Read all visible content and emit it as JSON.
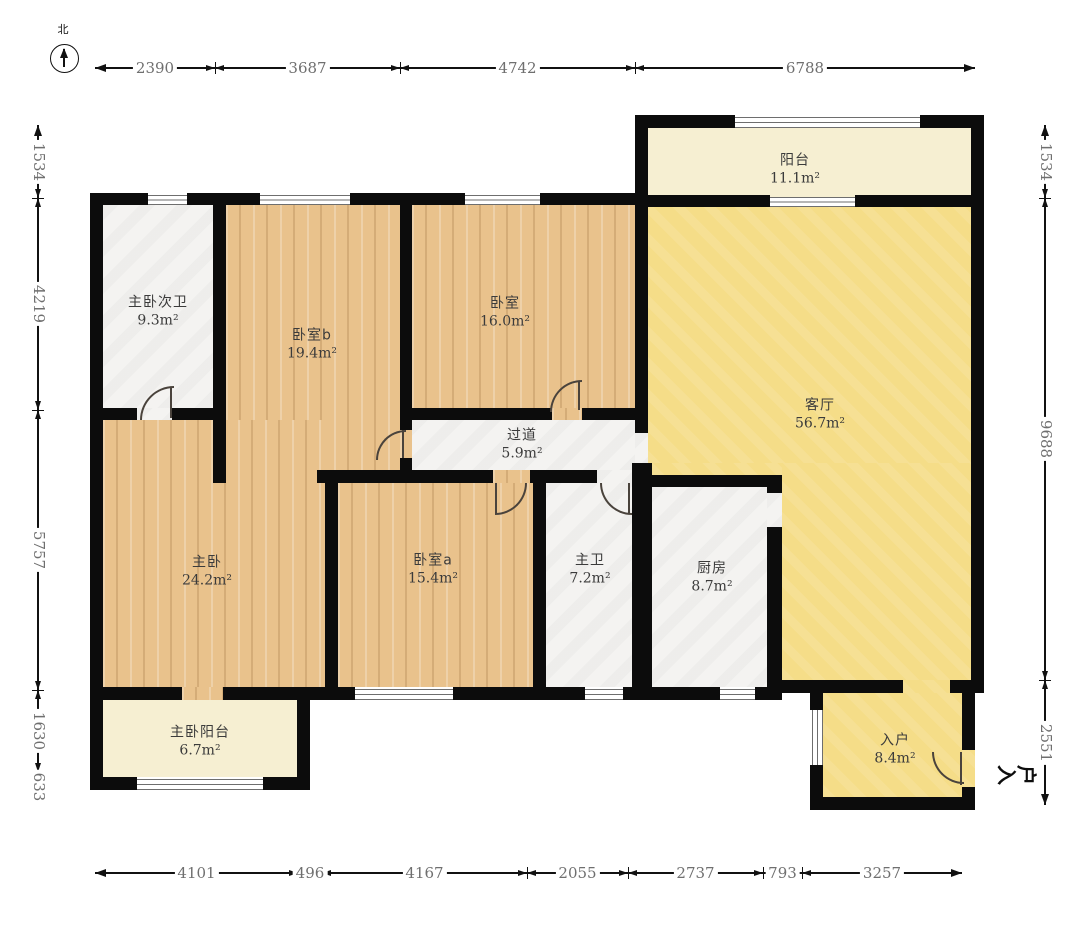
{
  "compass": {
    "label": "北"
  },
  "entry_label": "入户",
  "colors": {
    "wall": "#0c0c0c",
    "wood_floor": "#e9c28c",
    "living_floor": "#f5dd88",
    "balcony_floor": "#f6efd2",
    "tile_floor": "#f4f3f1",
    "dimension_text": "#6f6f6f",
    "label_text": "#3b3b3b"
  },
  "rooms": [
    {
      "id": "zhuwo-ciwei",
      "name": "主卧次卫",
      "area": "9.3m²",
      "floor": "tile",
      "label": [
        158,
        312
      ],
      "rects": [
        [
          103,
          205,
          110,
          203
        ],
        [
          137,
          408,
          35,
          12
        ]
      ]
    },
    {
      "id": "woshi-b",
      "name": "卧室b",
      "area": "19.4m²",
      "floor": "wood",
      "label": [
        312,
        345
      ],
      "rects": [
        [
          226,
          205,
          174,
          265
        ],
        [
          400,
          430,
          12,
          28
        ],
        [
          226,
          470,
          91,
          13
        ]
      ]
    },
    {
      "id": "woshi",
      "name": "卧室",
      "area": "16.0m²",
      "floor": "wood",
      "label": [
        505,
        313
      ],
      "rects": [
        [
          412,
          205,
          223,
          203
        ],
        [
          552,
          408,
          30,
          12
        ]
      ]
    },
    {
      "id": "yangtai",
      "name": "阳台",
      "area": "11.1m²",
      "floor": "cream",
      "label": [
        795,
        170
      ],
      "rects": [
        [
          648,
          128,
          325,
          67
        ],
        [
          770,
          195,
          85,
          12
        ]
      ]
    },
    {
      "id": "keting",
      "name": "客厅",
      "area": "56.7m²",
      "floor": "yellow",
      "label": [
        820,
        415
      ],
      "rects": [
        [
          648,
          207,
          325,
          256
        ],
        [
          782,
          463,
          191,
          217
        ],
        [
          652,
          463,
          130,
          12
        ],
        [
          903,
          680,
          47,
          13
        ]
      ]
    },
    {
      "id": "guodao",
      "name": "过道",
      "area": "5.9m²",
      "floor": "tile",
      "label": [
        522,
        445
      ],
      "rects": [
        [
          412,
          420,
          223,
          50
        ],
        [
          635,
          433,
          13,
          30
        ]
      ]
    },
    {
      "id": "zhuwo",
      "name": "主卧",
      "area": "24.2m²",
      "floor": "wood",
      "label": [
        207,
        572
      ],
      "rects": [
        [
          103,
          420,
          222,
          267
        ],
        [
          182,
          687,
          41,
          13
        ]
      ]
    },
    {
      "id": "woshi-a",
      "name": "卧室a",
      "area": "15.4m²",
      "floor": "wood",
      "label": [
        433,
        570
      ],
      "rects": [
        [
          338,
          483,
          195,
          204
        ],
        [
          493,
          470,
          37,
          13
        ]
      ]
    },
    {
      "id": "zhuwei",
      "name": "主卫",
      "area": "7.2m²",
      "floor": "tile",
      "label": [
        590,
        570
      ],
      "rects": [
        [
          546,
          483,
          86,
          204
        ],
        [
          597,
          470,
          36,
          13
        ]
      ]
    },
    {
      "id": "chufang",
      "name": "厨房",
      "area": "8.7m²",
      "floor": "tile",
      "label": [
        712,
        578
      ],
      "rects": [
        [
          652,
          487,
          115,
          200
        ],
        [
          767,
          493,
          15,
          34
        ]
      ]
    },
    {
      "id": "zhuwo-yangtai",
      "name": "主卧阳台",
      "area": "6.7m²",
      "floor": "cream",
      "label": [
        200,
        742
      ],
      "rects": [
        [
          103,
          700,
          194,
          77
        ]
      ]
    },
    {
      "id": "ruhu",
      "name": "入户",
      "area": "8.4m²",
      "floor": "yellow",
      "label": [
        895,
        750
      ],
      "rects": [
        [
          823,
          693,
          139,
          104
        ],
        [
          962,
          750,
          13,
          37
        ]
      ]
    }
  ],
  "walls": [
    [
      635,
      115,
      13,
      92
    ],
    [
      648,
      115,
      87,
      13
    ],
    [
      920,
      115,
      53,
      13
    ],
    [
      971,
      115,
      13,
      578
    ],
    [
      648,
      195,
      122,
      12
    ],
    [
      855,
      195,
      118,
      12
    ],
    [
      90,
      193,
      13,
      597
    ],
    [
      90,
      193,
      58,
      12
    ],
    [
      187,
      193,
      73,
      12
    ],
    [
      350,
      193,
      115,
      12
    ],
    [
      540,
      193,
      108,
      12
    ],
    [
      213,
      193,
      13,
      290
    ],
    [
      90,
      408,
      47,
      12
    ],
    [
      172,
      408,
      54,
      12
    ],
    [
      400,
      193,
      12,
      237
    ],
    [
      400,
      458,
      12,
      25
    ],
    [
      412,
      408,
      140,
      12
    ],
    [
      582,
      408,
      66,
      12
    ],
    [
      635,
      193,
      13,
      240
    ],
    [
      632,
      463,
      20,
      224
    ],
    [
      317,
      470,
      176,
      13
    ],
    [
      530,
      470,
      67,
      13
    ],
    [
      633,
      470,
      17,
      13
    ],
    [
      325,
      470,
      13,
      230
    ],
    [
      533,
      483,
      13,
      204
    ],
    [
      652,
      475,
      130,
      12
    ],
    [
      767,
      475,
      15,
      18
    ],
    [
      767,
      527,
      15,
      160
    ],
    [
      90,
      687,
      92,
      13
    ],
    [
      223,
      687,
      132,
      13
    ],
    [
      453,
      687,
      132,
      13
    ],
    [
      623,
      687,
      97,
      13
    ],
    [
      755,
      687,
      27,
      13
    ],
    [
      782,
      680,
      121,
      13
    ],
    [
      950,
      680,
      34,
      13
    ],
    [
      810,
      693,
      13,
      17
    ],
    [
      810,
      765,
      13,
      45
    ],
    [
      810,
      797,
      165,
      13
    ],
    [
      962,
      687,
      13,
      63
    ],
    [
      962,
      787,
      13,
      23
    ],
    [
      297,
      700,
      13,
      90
    ],
    [
      90,
      777,
      47,
      13
    ],
    [
      263,
      777,
      47,
      13
    ]
  ],
  "windows": [
    {
      "x": 735,
      "y": 117,
      "w": 185,
      "h": 9,
      "dir": "h"
    },
    {
      "x": 148,
      "y": 195,
      "w": 39,
      "h": 8,
      "dir": "h"
    },
    {
      "x": 260,
      "y": 195,
      "w": 90,
      "h": 8,
      "dir": "h"
    },
    {
      "x": 465,
      "y": 195,
      "w": 75,
      "h": 8,
      "dir": "h"
    },
    {
      "x": 770,
      "y": 197,
      "w": 85,
      "h": 8,
      "dir": "h"
    },
    {
      "x": 355,
      "y": 689,
      "w": 98,
      "h": 9,
      "dir": "h"
    },
    {
      "x": 585,
      "y": 689,
      "w": 38,
      "h": 9,
      "dir": "h"
    },
    {
      "x": 720,
      "y": 689,
      "w": 35,
      "h": 9,
      "dir": "h"
    },
    {
      "x": 137,
      "y": 779,
      "w": 126,
      "h": 9,
      "dir": "h"
    },
    {
      "x": 812,
      "y": 710,
      "w": 9,
      "h": 55,
      "dir": "v"
    }
  ],
  "doors": [
    {
      "x": 140,
      "y": 386,
      "r": 32,
      "corner": "tl"
    },
    {
      "x": 376,
      "y": 430,
      "r": 28,
      "corner": "tl"
    },
    {
      "x": 550,
      "y": 380,
      "r": 30,
      "corner": "tl"
    },
    {
      "x": 495,
      "y": 483,
      "r": 30,
      "corner": "br"
    },
    {
      "x": 600,
      "y": 483,
      "r": 30,
      "corner": "bl"
    },
    {
      "x": 932,
      "y": 752,
      "r": 30,
      "corner": "bl"
    }
  ],
  "door_leaves": [
    [
      170,
      388,
      2,
      30
    ],
    [
      402,
      430,
      2,
      28
    ],
    [
      578,
      382,
      2,
      28
    ],
    [
      495,
      483,
      2,
      30
    ],
    [
      628,
      483,
      2,
      30
    ],
    [
      960,
      752,
      2,
      33
    ]
  ],
  "dimensions": [
    {
      "id": "top",
      "axis": "x",
      "line": 68,
      "points": [
        95,
        215,
        400,
        635,
        975
      ],
      "labels": [
        "2390",
        "3687",
        "4742",
        "6788"
      ]
    },
    {
      "id": "bottom",
      "axis": "x",
      "line": 873,
      "points": [
        95,
        298,
        322,
        527,
        628,
        763,
        802,
        962
      ],
      "labels": [
        "4101",
        "496",
        "4167",
        "2055",
        "2737",
        "793",
        "3257"
      ]
    },
    {
      "id": "left",
      "axis": "y",
      "line": 38,
      "points": [
        125,
        198,
        410,
        690,
        772,
        802
      ],
      "labels": [
        "1534",
        "4219",
        "5757",
        "1630",
        "633"
      ]
    },
    {
      "id": "right",
      "axis": "y",
      "line": 1045,
      "points": [
        125,
        198,
        680,
        805
      ],
      "labels": [
        "1534",
        "9688",
        "2551"
      ]
    }
  ]
}
